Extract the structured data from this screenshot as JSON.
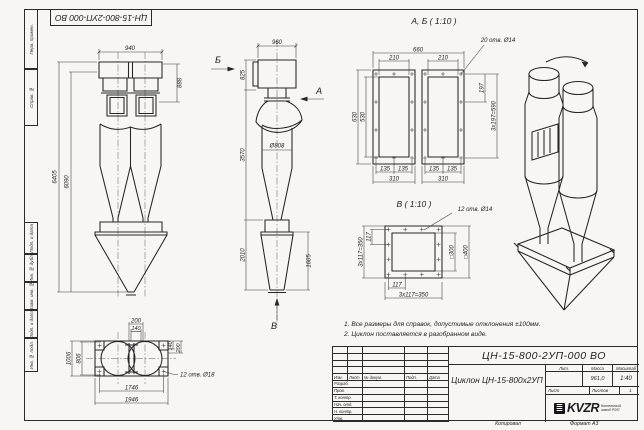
{
  "stamp_top": {
    "code": "ЦН-15-800-2УП-000 ВО"
  },
  "frame": {
    "side_labels": [
      "Перв. примен.",
      "Справ. №",
      "Подп. и дата",
      "Инв. № дубл.",
      "Взам. инв. №",
      "Подп. и дата",
      "Инв. № подл."
    ]
  },
  "notes": {
    "line1": "1. Все размеры для справок, допустимые отклонения ±100мм.",
    "line2": "2. Циклон поставляется в разобранном виде."
  },
  "views": {
    "front": {
      "dim_w_top": "940",
      "dim_inlet_h": "888",
      "dim_h_total": "6405",
      "dim_h_body": "6090",
      "label_b": "Б"
    },
    "side": {
      "dim_w_top": "960",
      "dim_h_top": "825",
      "dim_h_mid": "3570",
      "dim_dia": "Ø808",
      "dim_h_bottom": "2010",
      "dim_h_cone": "1605",
      "label_a": "А",
      "label_v": "В"
    },
    "ab": {
      "title": "А, Б ( 1:10 )",
      "holes_note": "20 отв. Ø14",
      "dim_total_w": "660",
      "dim_inner_w_l": "210",
      "dim_inner_w_r": "210",
      "dim_outer_h": "630",
      "dim_inner_h": "530",
      "dim_pitch": "197",
      "dim_pitch_total": "3x197=590",
      "dim_135_1": "135",
      "dim_135_2": "135",
      "dim_135_3": "135",
      "dim_135_4": "135",
      "dim_310_l": "310",
      "dim_310_r": "310"
    },
    "v": {
      "title": "В ( 1:10 )",
      "holes_note": "12 отв. Ø14",
      "dim_pitch_left": "3x117=350",
      "dim_117_top": "117",
      "dim_inner_sq": "□300",
      "dim_outer_sq": "□400",
      "dim_117_bottom": "117",
      "dim_pitch_bottom": "3x117=350"
    },
    "plan": {
      "holes_note": "12 отв. Ø18",
      "dim_200_top": "200",
      "dim_140_top": "140",
      "dim_140_right": "140",
      "dim_200_right": "200",
      "dim_outer_h": "1006",
      "dim_inner_h": "806",
      "dim_inner_w": "1746",
      "dim_outer_w": "1946"
    }
  },
  "title_block": {
    "doc_code": "ЦН-15-800-2УП-000 ВО",
    "product_name": "Циклон ЦН-15-800х2УП",
    "cols": [
      "Изм.",
      "Лист",
      "№ докум.",
      "Подп.",
      "Дата"
    ],
    "rows": [
      "Разраб.",
      "Пров.",
      "Т. контр.",
      "Нач. отд.",
      "Н. контр.",
      "Утв."
    ],
    "lit_label": "Лит.",
    "mass_label": "Масса",
    "scale_label": "Масштаб",
    "mass": "961,0",
    "scale": "1:40",
    "sheet_label": "Лист",
    "sheets_label": "Листов",
    "sheets_value": "1",
    "company_logo": "KVZR",
    "company_name": "Котельный завод РЭП",
    "copied_label": "Копировал",
    "format_label": "Формат А3"
  }
}
